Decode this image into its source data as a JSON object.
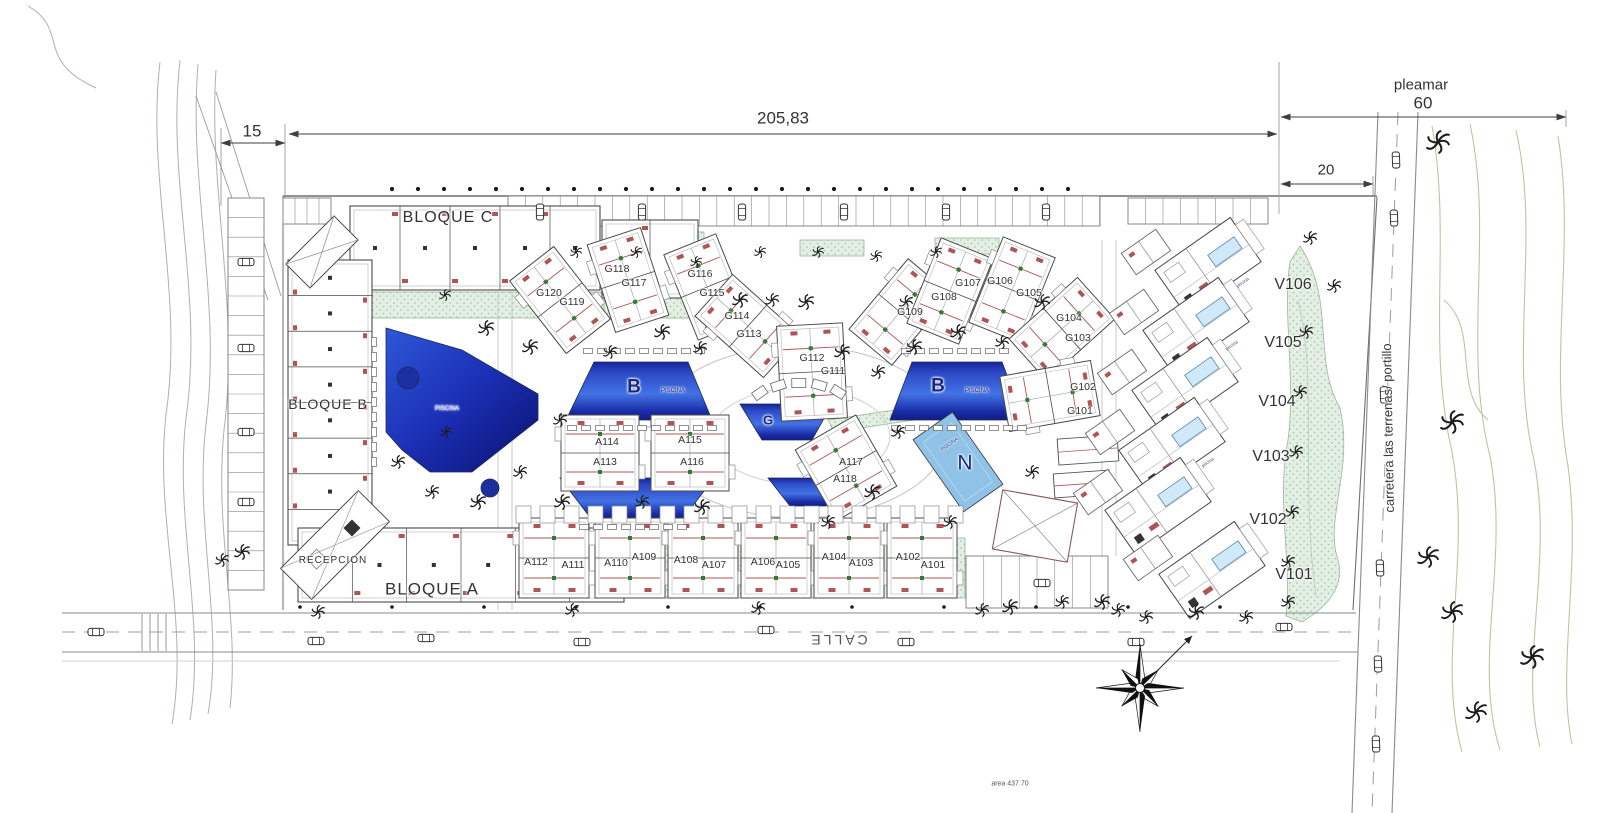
{
  "drawing": {
    "kind": "residential site plan"
  },
  "colors": {
    "line": "#4a4a4a",
    "light": "#b9b9b9",
    "red": "#b05555",
    "green_fill": "#e3efe3",
    "green_edge": "#9bb89b",
    "pool_dark": "#101c86",
    "pool_mid": "#4272e4",
    "pool_light": "#8fc2e6",
    "villa_pool": "#cfe9f8",
    "tree": "#1c1c1c",
    "tree_green": "#2e6b34",
    "road": "#8a8a8a",
    "text": "#333333",
    "pool_text": "#16277e"
  },
  "labels": {
    "dimensions": [
      {
        "id": "dim-15",
        "text": "15",
        "x": 252,
        "y": 131,
        "size": 17
      },
      {
        "id": "dim-205-83",
        "text": "205,83",
        "x": 783,
        "y": 118,
        "size": 17
      },
      {
        "id": "pleamar",
        "text": "pleamar",
        "x": 1421,
        "y": 85,
        "size": 15
      },
      {
        "id": "dim-60",
        "text": "60",
        "x": 1423,
        "y": 103,
        "size": 17
      },
      {
        "id": "dim-20",
        "text": "20",
        "x": 1326,
        "y": 170,
        "size": 15
      }
    ],
    "blocks": [
      {
        "id": "bloque-c",
        "text": "BLOQUE C",
        "x": 448,
        "y": 218,
        "size": 16,
        "ls": 1
      },
      {
        "id": "bloque-b",
        "text": "BLOQUE B",
        "x": 328,
        "y": 404,
        "size": 14,
        "ls": 1
      },
      {
        "id": "bloque-a",
        "text": "BLOQUE A",
        "x": 432,
        "y": 589,
        "size": 17,
        "ls": 1
      },
      {
        "id": "recepcion",
        "text": "RECEPCION",
        "x": 333,
        "y": 561,
        "size": 10,
        "ls": 1
      }
    ],
    "units_g": [
      {
        "id": "g120",
        "text": "G120",
        "x": 549,
        "y": 293,
        "size": 10.5
      },
      {
        "id": "g119",
        "text": "G119",
        "x": 572,
        "y": 302,
        "size": 10.5
      },
      {
        "id": "g118",
        "text": "G118",
        "x": 617,
        "y": 269,
        "size": 10.5
      },
      {
        "id": "g117",
        "text": "G117",
        "x": 634,
        "y": 283,
        "size": 10.5
      },
      {
        "id": "g116",
        "text": "G116",
        "x": 700,
        "y": 274,
        "size": 10.5
      },
      {
        "id": "g115",
        "text": "G115",
        "x": 712,
        "y": 293,
        "size": 10.5
      },
      {
        "id": "g114",
        "text": "G114",
        "x": 737,
        "y": 316,
        "size": 10.5
      },
      {
        "id": "g113",
        "text": "G113",
        "x": 749,
        "y": 334,
        "size": 10.5
      },
      {
        "id": "g112",
        "text": "G112",
        "x": 812,
        "y": 358,
        "size": 10.5
      },
      {
        "id": "g111",
        "text": "G111",
        "x": 833,
        "y": 371,
        "size": 10.5
      },
      {
        "id": "g109",
        "text": "G109",
        "x": 910,
        "y": 312,
        "size": 10.5
      },
      {
        "id": "g108",
        "text": "G108",
        "x": 944,
        "y": 297,
        "size": 10.5
      },
      {
        "id": "g107",
        "text": "G107",
        "x": 968,
        "y": 283,
        "size": 10.5
      },
      {
        "id": "g106",
        "text": "G106",
        "x": 1000,
        "y": 281,
        "size": 10.5
      },
      {
        "id": "g105",
        "text": "G105",
        "x": 1029,
        "y": 293,
        "size": 10.5
      },
      {
        "id": "g104",
        "text": "G104",
        "x": 1069,
        "y": 318,
        "size": 10.5
      },
      {
        "id": "g103",
        "text": "G103",
        "x": 1078,
        "y": 338,
        "size": 10.5
      },
      {
        "id": "g102",
        "text": "G102",
        "x": 1083,
        "y": 387,
        "size": 10.5
      },
      {
        "id": "g101",
        "text": "G101",
        "x": 1080,
        "y": 411,
        "size": 10.5
      }
    ],
    "units_a": [
      {
        "id": "a114",
        "text": "A114",
        "x": 607,
        "y": 442,
        "size": 10.5
      },
      {
        "id": "a113",
        "text": "A113",
        "x": 605,
        "y": 462,
        "size": 10.5
      },
      {
        "id": "a115",
        "text": "A115",
        "x": 690,
        "y": 440,
        "size": 10.5
      },
      {
        "id": "a116",
        "text": "A116",
        "x": 692,
        "y": 462,
        "size": 10.5
      },
      {
        "id": "a117",
        "text": "A117",
        "x": 851,
        "y": 462,
        "size": 10.5
      },
      {
        "id": "a118",
        "text": "A118",
        "x": 845,
        "y": 479,
        "size": 10.5
      },
      {
        "id": "a112",
        "text": "A112",
        "x": 536,
        "y": 562,
        "size": 10.5
      },
      {
        "id": "a111",
        "text": "A111",
        "x": 573,
        "y": 565,
        "size": 10.5
      },
      {
        "id": "a110",
        "text": "A110",
        "x": 616,
        "y": 563,
        "size": 10.5
      },
      {
        "id": "a109",
        "text": "A109",
        "x": 644,
        "y": 557,
        "size": 10.5
      },
      {
        "id": "a108",
        "text": "A108",
        "x": 686,
        "y": 560,
        "size": 10.5
      },
      {
        "id": "a107",
        "text": "A107",
        "x": 714,
        "y": 565,
        "size": 10.5
      },
      {
        "id": "a106",
        "text": "A106",
        "x": 763,
        "y": 562,
        "size": 10.5
      },
      {
        "id": "a105",
        "text": "A105",
        "x": 788,
        "y": 565,
        "size": 10.5
      },
      {
        "id": "a104",
        "text": "A104",
        "x": 834,
        "y": 557,
        "size": 10.5
      },
      {
        "id": "a103",
        "text": "A103",
        "x": 861,
        "y": 563,
        "size": 10.5
      },
      {
        "id": "a102",
        "text": "A102",
        "x": 908,
        "y": 557,
        "size": 10.5
      },
      {
        "id": "a101",
        "text": "A101",
        "x": 933,
        "y": 565,
        "size": 10.5
      }
    ],
    "units_v": [
      {
        "id": "v106",
        "text": "V106",
        "x": 1293,
        "y": 285,
        "size": 16
      },
      {
        "id": "v105",
        "text": "V105",
        "x": 1283,
        "y": 343,
        "size": 16
      },
      {
        "id": "v104",
        "text": "V104",
        "x": 1277,
        "y": 402,
        "size": 16
      },
      {
        "id": "v103",
        "text": "V103",
        "x": 1271,
        "y": 457,
        "size": 16
      },
      {
        "id": "v102",
        "text": "V102",
        "x": 1268,
        "y": 520,
        "size": 16
      },
      {
        "id": "v101",
        "text": "V101",
        "x": 1294,
        "y": 575,
        "size": 16
      }
    ],
    "pools": [
      {
        "id": "pool-b-left",
        "text": "B",
        "x": 634,
        "y": 387,
        "size": 19,
        "color": "#16277e",
        "weight": "bold"
      },
      {
        "id": "pool-b-left-piscina",
        "text": "PISCINA",
        "x": 673,
        "y": 391,
        "size": 6,
        "color": "#16277e"
      },
      {
        "id": "pool-b-right",
        "text": "B",
        "x": 938,
        "y": 386,
        "size": 19,
        "color": "#16277e",
        "weight": "bold"
      },
      {
        "id": "pool-b-right-piscina",
        "text": "PISCINA",
        "x": 977,
        "y": 391,
        "size": 6,
        "color": "#16277e"
      },
      {
        "id": "pool-g",
        "text": "G",
        "x": 768,
        "y": 420,
        "size": 13,
        "color": "#16277e",
        "weight": "bold"
      },
      {
        "id": "pool-n",
        "text": "N",
        "x": 965,
        "y": 463,
        "size": 21,
        "color": "#16277e"
      },
      {
        "id": "pool-n-piscina",
        "text": "PISCINA",
        "x": 950,
        "y": 445,
        "size": 5,
        "rot": -35,
        "color": "#1c3c8c"
      },
      {
        "id": "pool-main-piscina",
        "text": "PISCINA",
        "x": 447,
        "y": 409,
        "size": 6,
        "color": "#cfe0ff"
      },
      {
        "id": "villa-piscina-v106",
        "text": "piscina",
        "x": 1243,
        "y": 283,
        "size": 4.5,
        "rot": -35,
        "color": "#33557a"
      },
      {
        "id": "villa-piscina-v105",
        "text": "piscina",
        "x": 1232,
        "y": 346,
        "size": 4.5,
        "rot": -35,
        "color": "#33557a"
      },
      {
        "id": "villa-piscina-v102",
        "text": "piscina",
        "x": 1208,
        "y": 463,
        "size": 4.5,
        "rot": -35,
        "color": "#33557a"
      }
    ],
    "roads": [
      {
        "id": "calle",
        "text": "CALLE",
        "x": 838,
        "y": 640,
        "size": 14,
        "rot": 180,
        "ls": 3,
        "color": "#555555"
      },
      {
        "id": "carretera",
        "text": "carretera las terrenas/ portillo",
        "x": 1388,
        "y": 428,
        "size": 13,
        "rot": -91,
        "color": "#3a3a3a"
      }
    ],
    "notes": [
      {
        "id": "area-note",
        "text": "area  437.70",
        "x": 1010,
        "y": 784,
        "size": 7,
        "color": "#555555"
      }
    ]
  }
}
